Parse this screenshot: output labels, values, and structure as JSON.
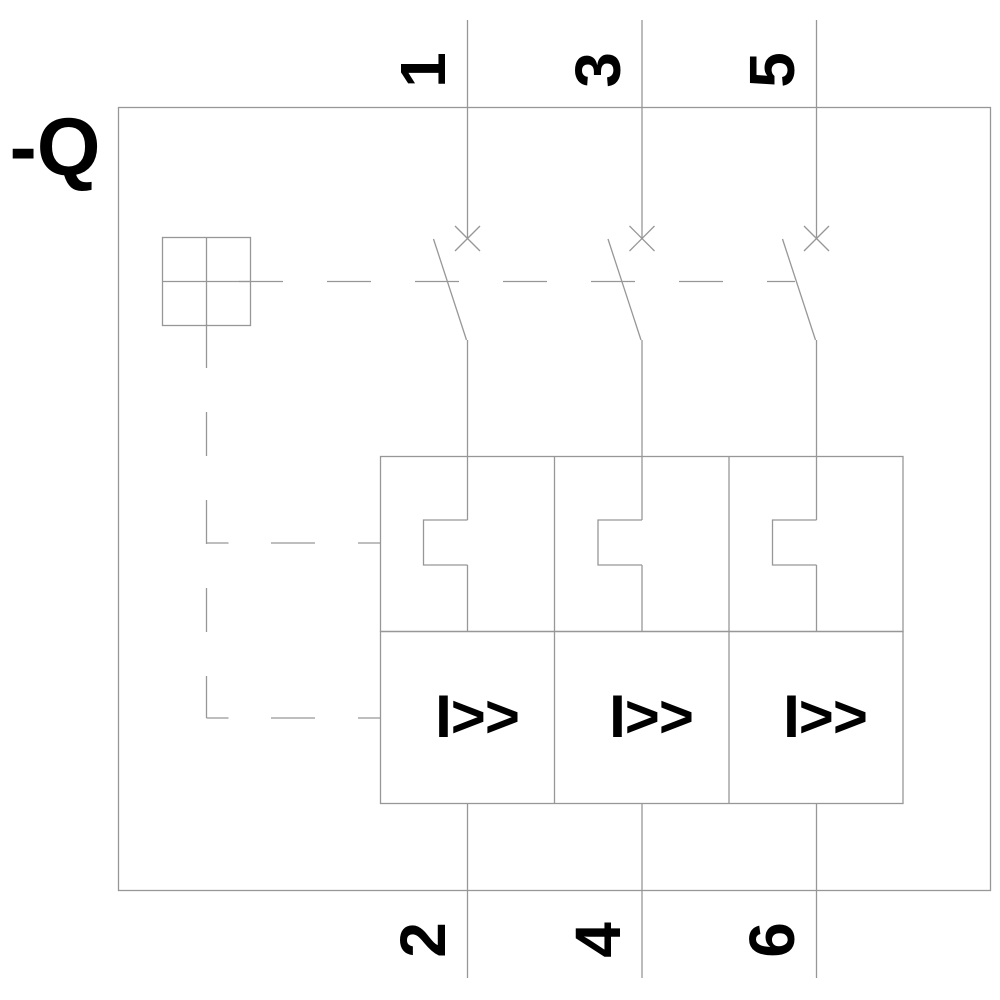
{
  "diagram": {
    "type": "electrical-schematic",
    "description": "3-pole circuit breaker / motor starter protector symbol, drawing rotated 90 degrees",
    "component_label": "-Q",
    "trip_symbol_label": "I>>",
    "poles": [
      {
        "id": 1,
        "top_terminal": "1",
        "bottom_terminal": "2"
      },
      {
        "id": 2,
        "top_terminal": "3",
        "bottom_terminal": "4"
      },
      {
        "id": 3,
        "top_terminal": "5",
        "bottom_terminal": "6"
      }
    ]
  },
  "colors": {
    "line": "#979797",
    "label": "#000000",
    "background": "#ffffff"
  }
}
